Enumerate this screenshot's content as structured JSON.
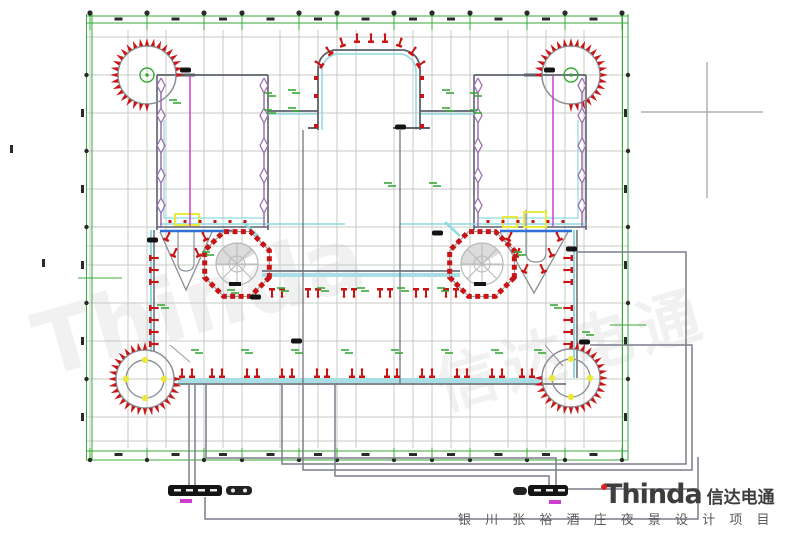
{
  "branding": {
    "logo_text": "Thinda",
    "logo_cn": "信达电通",
    "caption": "银 川 张 裕 酒 庄 夜 景 设 计 项 目"
  },
  "colors": {
    "axis_green": "#3aa83a",
    "grid_gray": "#c6cbc6",
    "wall_dark": "#5c616b",
    "wall_cyan": "#8fd9e0",
    "cyan_band": "#a9dfe4",
    "fixture_red": "#c81414",
    "zigzag_purple": "#9b6fae",
    "magenta": "#cf3fcf",
    "blue": "#2f6fd6",
    "conduit_gray": "#7c7f8a",
    "yellow": "#e9e93f",
    "stair_gray": "#b8b8b8",
    "box_black": "#141414",
    "bubble_dark": "#2a2a2a",
    "crosshair_gray": "#9aa0a6",
    "logo_accent": "#e0201f",
    "logo_text_color": "#3d3d3d",
    "caption_gray": "#5a5a5a"
  }
}
